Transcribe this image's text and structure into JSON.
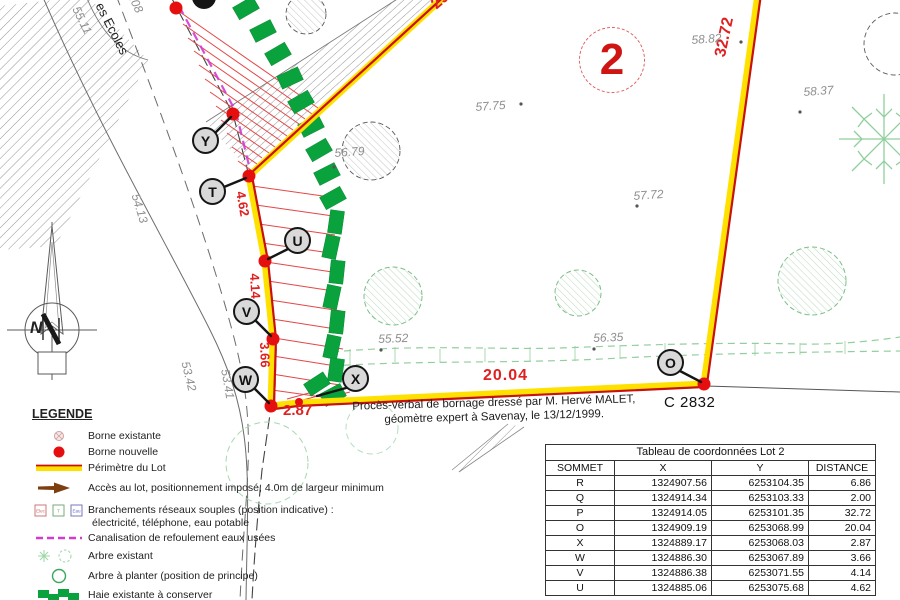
{
  "map": {
    "lot_number": "2",
    "parcel_id": "C 2832",
    "street_name": "es Ecoles",
    "compass_letter": "N",
    "survey_note_line1": "Procès-verbal de bornage dressé par M. Hervé MALET,",
    "survey_note_line2": "géomètre expert à Savenay, le 13/12/1999.",
    "vertex_labels": [
      "Y",
      "T",
      "U",
      "V",
      "W",
      "X",
      "O"
    ],
    "distance_labels": [
      "29.0",
      "32.72",
      "20.04",
      "2.87",
      "3.66",
      "4.14",
      "4.62"
    ],
    "elevation_labels": [
      "0.08",
      "55.11",
      "54.13",
      "53.42",
      "53.41",
      "56.79",
      "57.75",
      "58.82",
      "58.37",
      "57.72",
      "55.52",
      "56.35"
    ]
  },
  "legend": {
    "title": "LEGENDE",
    "items": [
      {
        "icon": "borne-existante-icon",
        "label": "Borne existante"
      },
      {
        "icon": "borne-nouvelle-icon",
        "label": "Borne nouvelle"
      },
      {
        "icon": "perimetre-icon",
        "label": "Périmètre du Lot"
      },
      {
        "icon": "acces-arrow-icon",
        "label": "Accès au lot, positionnement imposé, 4.0m de largeur minimum"
      },
      {
        "icon": "branchements-icon",
        "label": "Branchements réseaux souples (position indicative) :",
        "label2": "électricité, téléphone, eau potable",
        "squares": [
          "Elec",
          "T",
          "Eau"
        ]
      },
      {
        "icon": "canalisation-icon",
        "label": "Canalisation de refoulement eaux usées"
      },
      {
        "icon": "arbre-existant-icon",
        "label": "Arbre existant"
      },
      {
        "icon": "arbre-a-planter-icon",
        "label": "Arbre à planter (position de principe)"
      },
      {
        "icon": "haie-icon",
        "label": "Haie existante à conserver"
      }
    ]
  },
  "coordinates_table": {
    "title": "Tableau de coordonnées Lot 2",
    "columns": [
      "SOMMET",
      "X",
      "Y",
      "DISTANCE"
    ],
    "rows": [
      [
        "R",
        "1324907.56",
        "6253104.35",
        "6.86"
      ],
      [
        "Q",
        "1324914.34",
        "6253103.33",
        "2.00"
      ],
      [
        "P",
        "1324914.05",
        "6253101.35",
        "32.72"
      ],
      [
        "O",
        "1324909.19",
        "6253068.99",
        "20.04"
      ],
      [
        "X",
        "1324889.17",
        "6253068.03",
        "2.87"
      ],
      [
        "W",
        "1324886.30",
        "6253067.89",
        "3.66"
      ],
      [
        "V",
        "1324886.38",
        "6253071.55",
        "4.14"
      ],
      [
        "U",
        "1324885.06",
        "6253075.68",
        "4.62"
      ]
    ]
  },
  "colors": {
    "perimeter_yellow": "#ffe100",
    "perimeter_red": "#c81010",
    "borne_red": "#e60f0f",
    "hedge_green": "#0aa23d",
    "tree_green": "#8fcf9c",
    "distance_red": "#e02020",
    "elevation_gray": "#8f8f8f",
    "canalisation_magenta": "#cf3ccf"
  }
}
